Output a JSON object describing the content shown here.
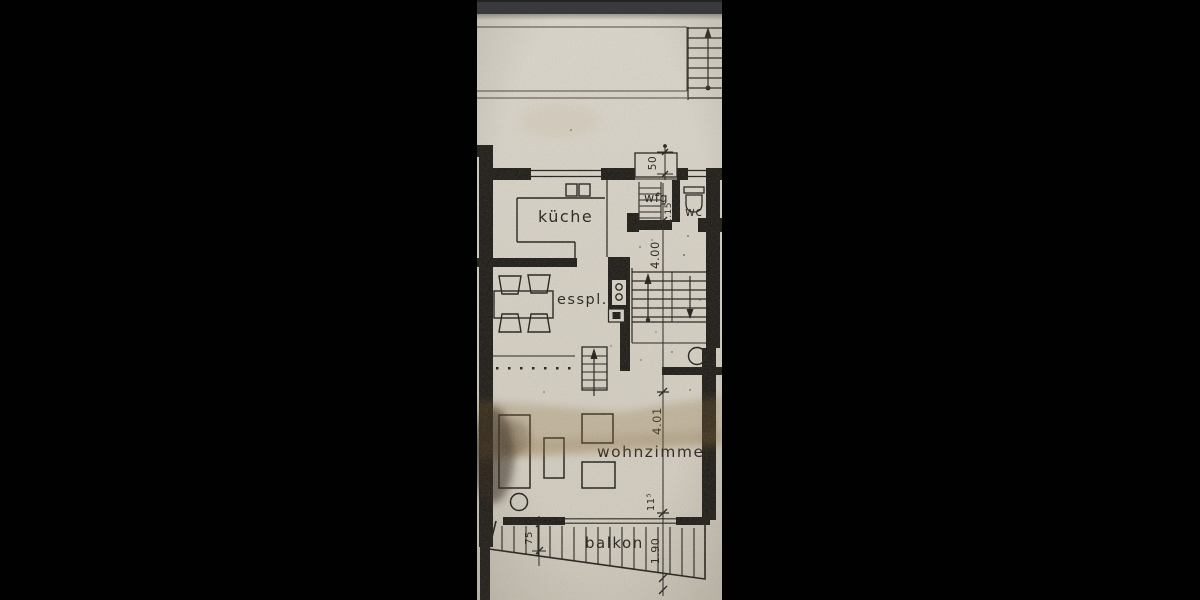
{
  "viewer": {
    "top_bar_color": "#3a3a3c",
    "letterbox_color": "#000000"
  },
  "floorplan": {
    "paper_color": "#d4cec2",
    "ink_color": "#211e19",
    "rooms": [
      {
        "id": "kueche",
        "label": "küche"
      },
      {
        "id": "esspl",
        "label": "esspl."
      },
      {
        "id": "wfg",
        "label": "wfg"
      },
      {
        "id": "wc",
        "label": "wc"
      },
      {
        "id": "wohnzimmer",
        "label": "wohnzimmer"
      },
      {
        "id": "balkon",
        "label": "balkon"
      }
    ],
    "dimensions": [
      {
        "id": "porch-depth",
        "label": "50"
      },
      {
        "id": "hall-width",
        "label": "1.15"
      },
      {
        "id": "hall-depth",
        "label": "4.00"
      },
      {
        "id": "living-depth",
        "label": "4.01"
      },
      {
        "id": "wall-segment",
        "label": "11⁵"
      },
      {
        "id": "balcony-depth-right",
        "label": "1.90"
      },
      {
        "id": "balcony-depth-left",
        "label": "75"
      }
    ]
  }
}
